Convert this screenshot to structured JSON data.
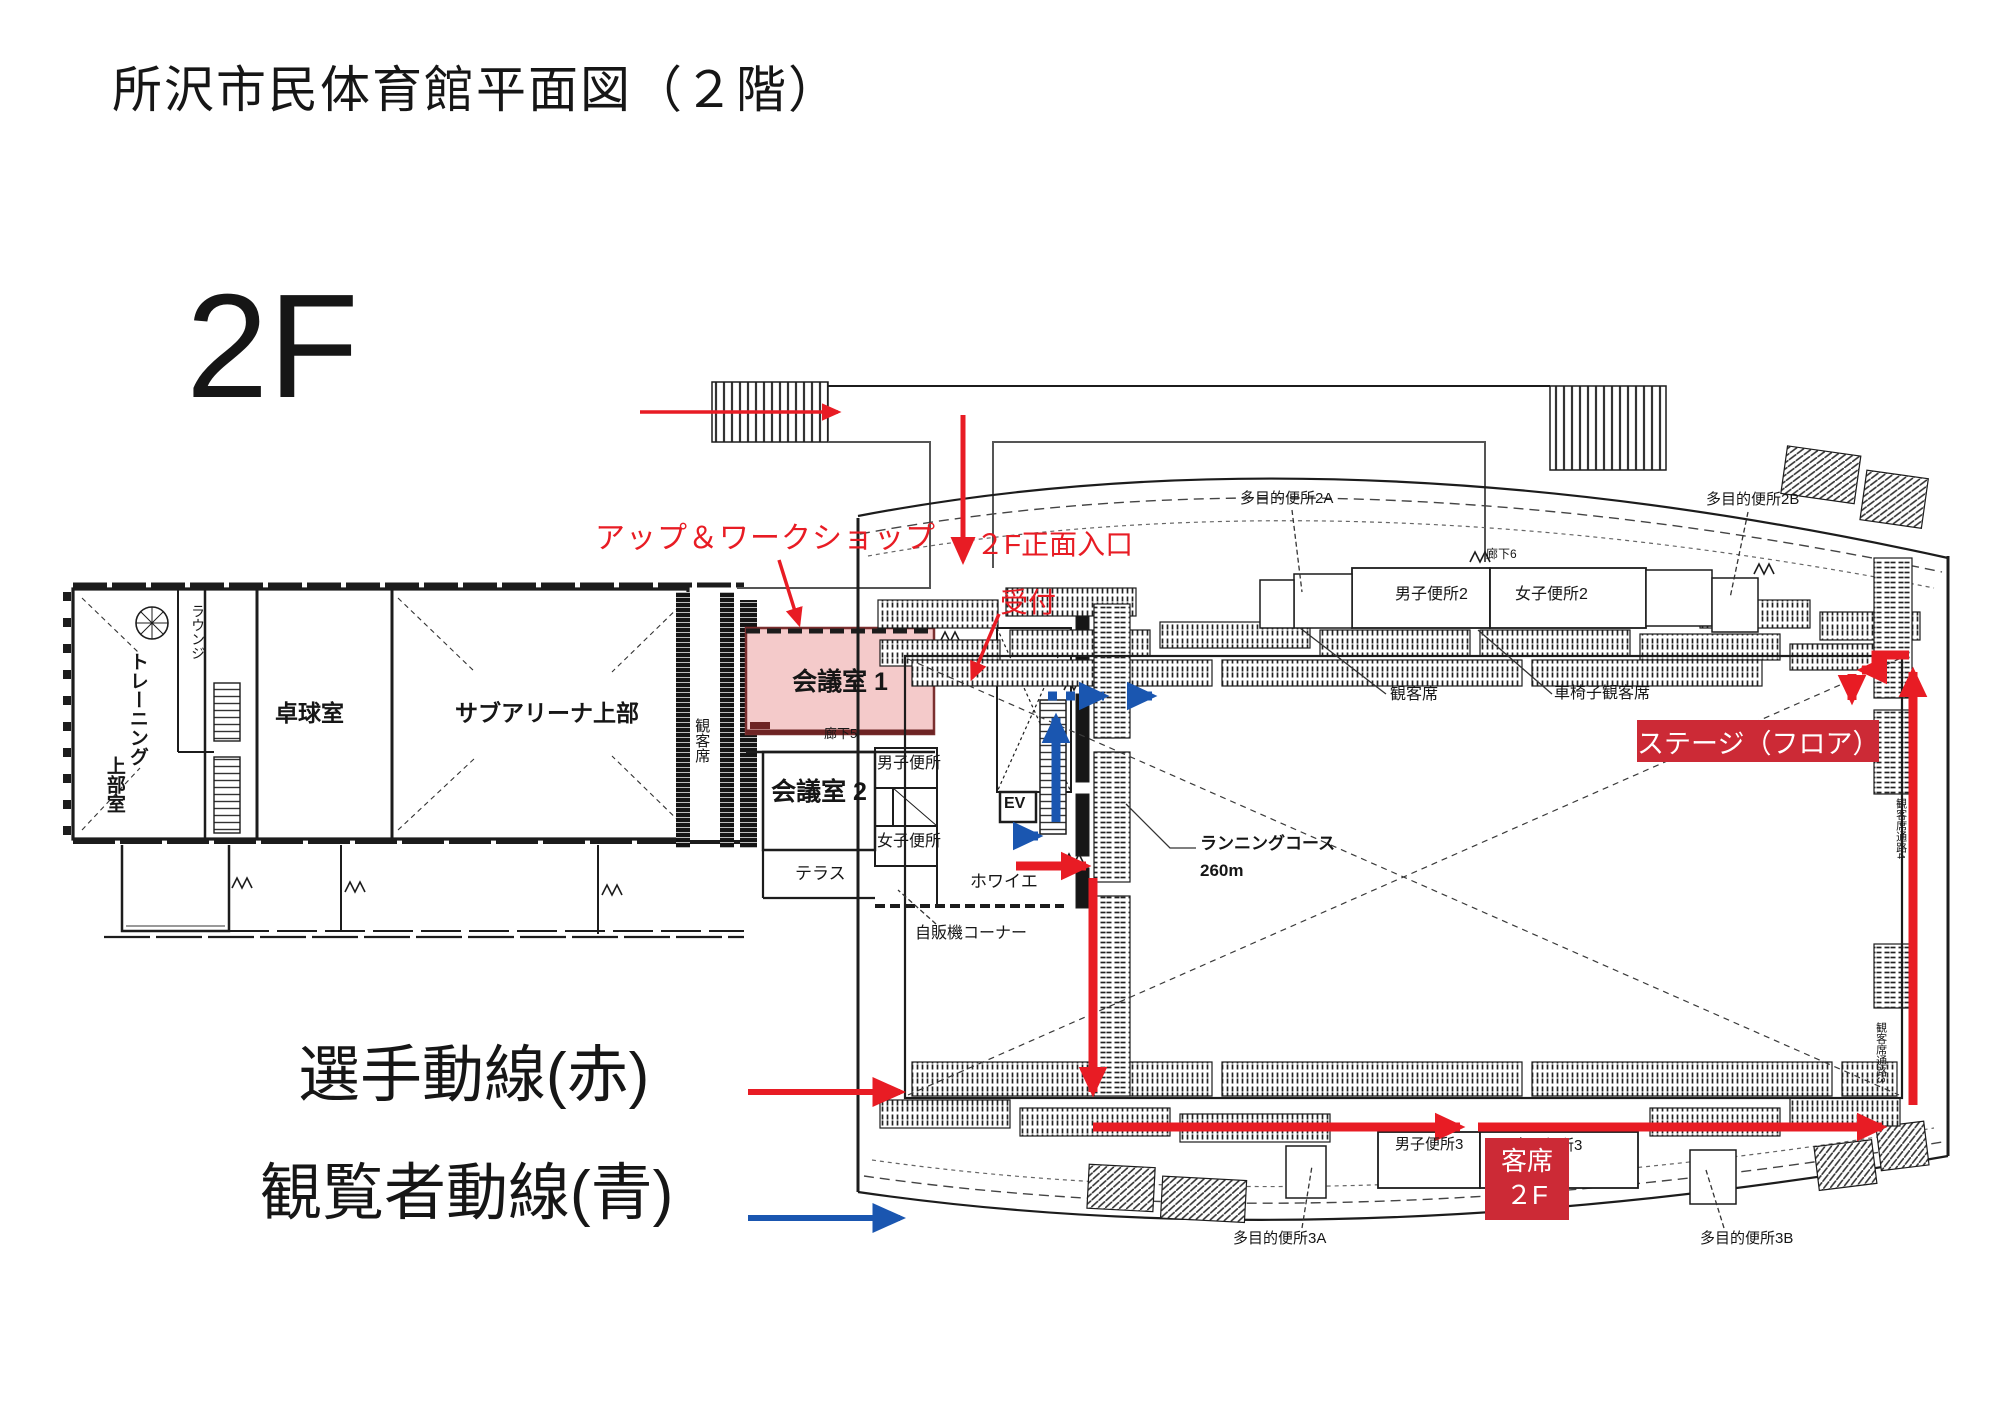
{
  "title": "所沢市民体育館平面図（２階）",
  "floor_mark": "2F",
  "legend": {
    "players": "選手動線(赤)",
    "spectators": "観覧者動線(青)"
  },
  "annotations": {
    "warmup": "アップ＆ワークショップ",
    "entrance": "２F正面入口",
    "reception": "受付"
  },
  "badges": {
    "stage": "ステージ（フロア）",
    "audience": {
      "line1": "客席",
      "line2": "２F"
    }
  },
  "left_wing": {
    "training_col1": "トレーニング",
    "training_col2": "上部室",
    "lounge": "ラウンジ",
    "table_tennis": "卓球室",
    "sub_arena": "サブアリーナ上部",
    "seats": "観客席"
  },
  "center": {
    "meeting1": "会議室 1",
    "corridor5": "廊下5",
    "meeting2": "会議室 2",
    "mens_wc": "男子便所",
    "womens_wc": "女子便所",
    "terrace": "テラス",
    "foyer": "ホワイエ",
    "elevator": "EV",
    "vending": "自販機コーナー"
  },
  "arena": {
    "multi_wc_2a": "多目的便所2A",
    "multi_wc_2b": "多目的便所2B",
    "corridor6": "廊下6",
    "mens_wc_2": "男子便所2",
    "womens_wc_2": "女子便所2",
    "seats": "観客席",
    "wheelchair_seats": "車椅子観客席",
    "running_course": "ランニングコース",
    "running_length": "260m",
    "mens_wc_3": "男子便所3",
    "womens_wc_3": "女子便所3",
    "multi_wc_3a": "多目的便所3A",
    "multi_wc_3b": "多目的便所3B",
    "aisle4": "観客席通路4",
    "aisle3": "観客席通路3"
  },
  "colors": {
    "route_red": "#e81c24",
    "route_blue": "#1a56b0",
    "badge_red": "#cc2a36",
    "meeting_room_highlight": "#f4caca",
    "meeting_room_border": "#7b2f2f"
  }
}
